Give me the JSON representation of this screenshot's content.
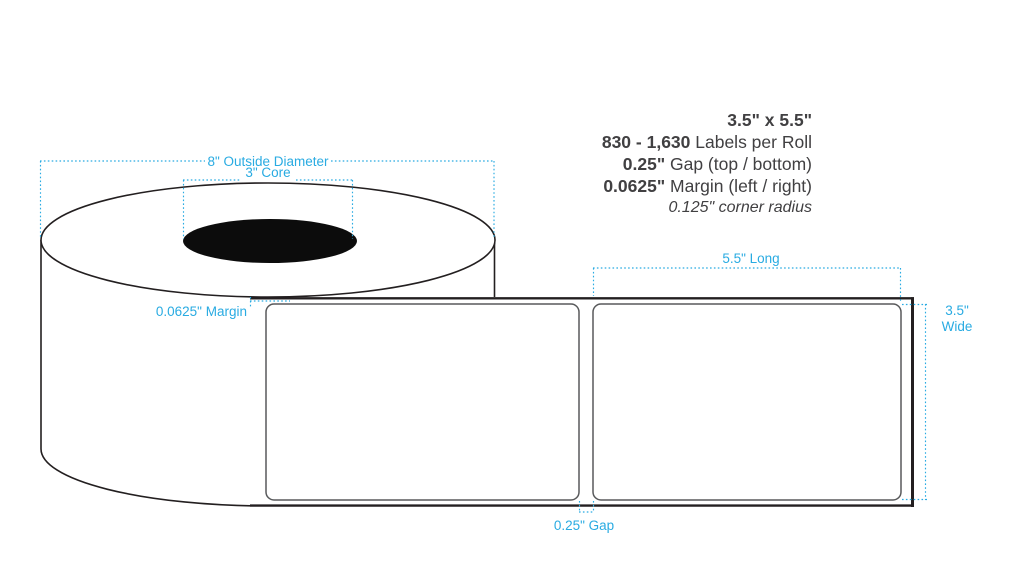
{
  "specs": {
    "lines": [
      {
        "bold": "3.5\" x 5.5\"",
        "rest": ""
      },
      {
        "bold": "830 - 1,630",
        "rest": " Labels per Roll"
      },
      {
        "bold": "0.25\"",
        "rest": " Gap (top / bottom)"
      },
      {
        "bold": "0.0625\"",
        "rest": " Margin (left / right)"
      }
    ],
    "corner_radius_note": "0.125\" corner radius"
  },
  "diagram": {
    "outside_diameter_label": "8\" Outside Diameter",
    "core_label": "3\" Core",
    "margin_label": "0.0625\" Margin",
    "long_label": "5.5\" Long",
    "wide_label_line1": "3.5\"",
    "wide_label_line2": "Wide",
    "gap_label": "0.25\" Gap"
  },
  "colors": {
    "dimension_blue": "#29ABE2",
    "outline_black": "#231F20",
    "label_border_gray": "#58595B",
    "spec_text_gray": "#414042",
    "core_fill": "#0C0C0C",
    "background": "#FFFFFF"
  }
}
